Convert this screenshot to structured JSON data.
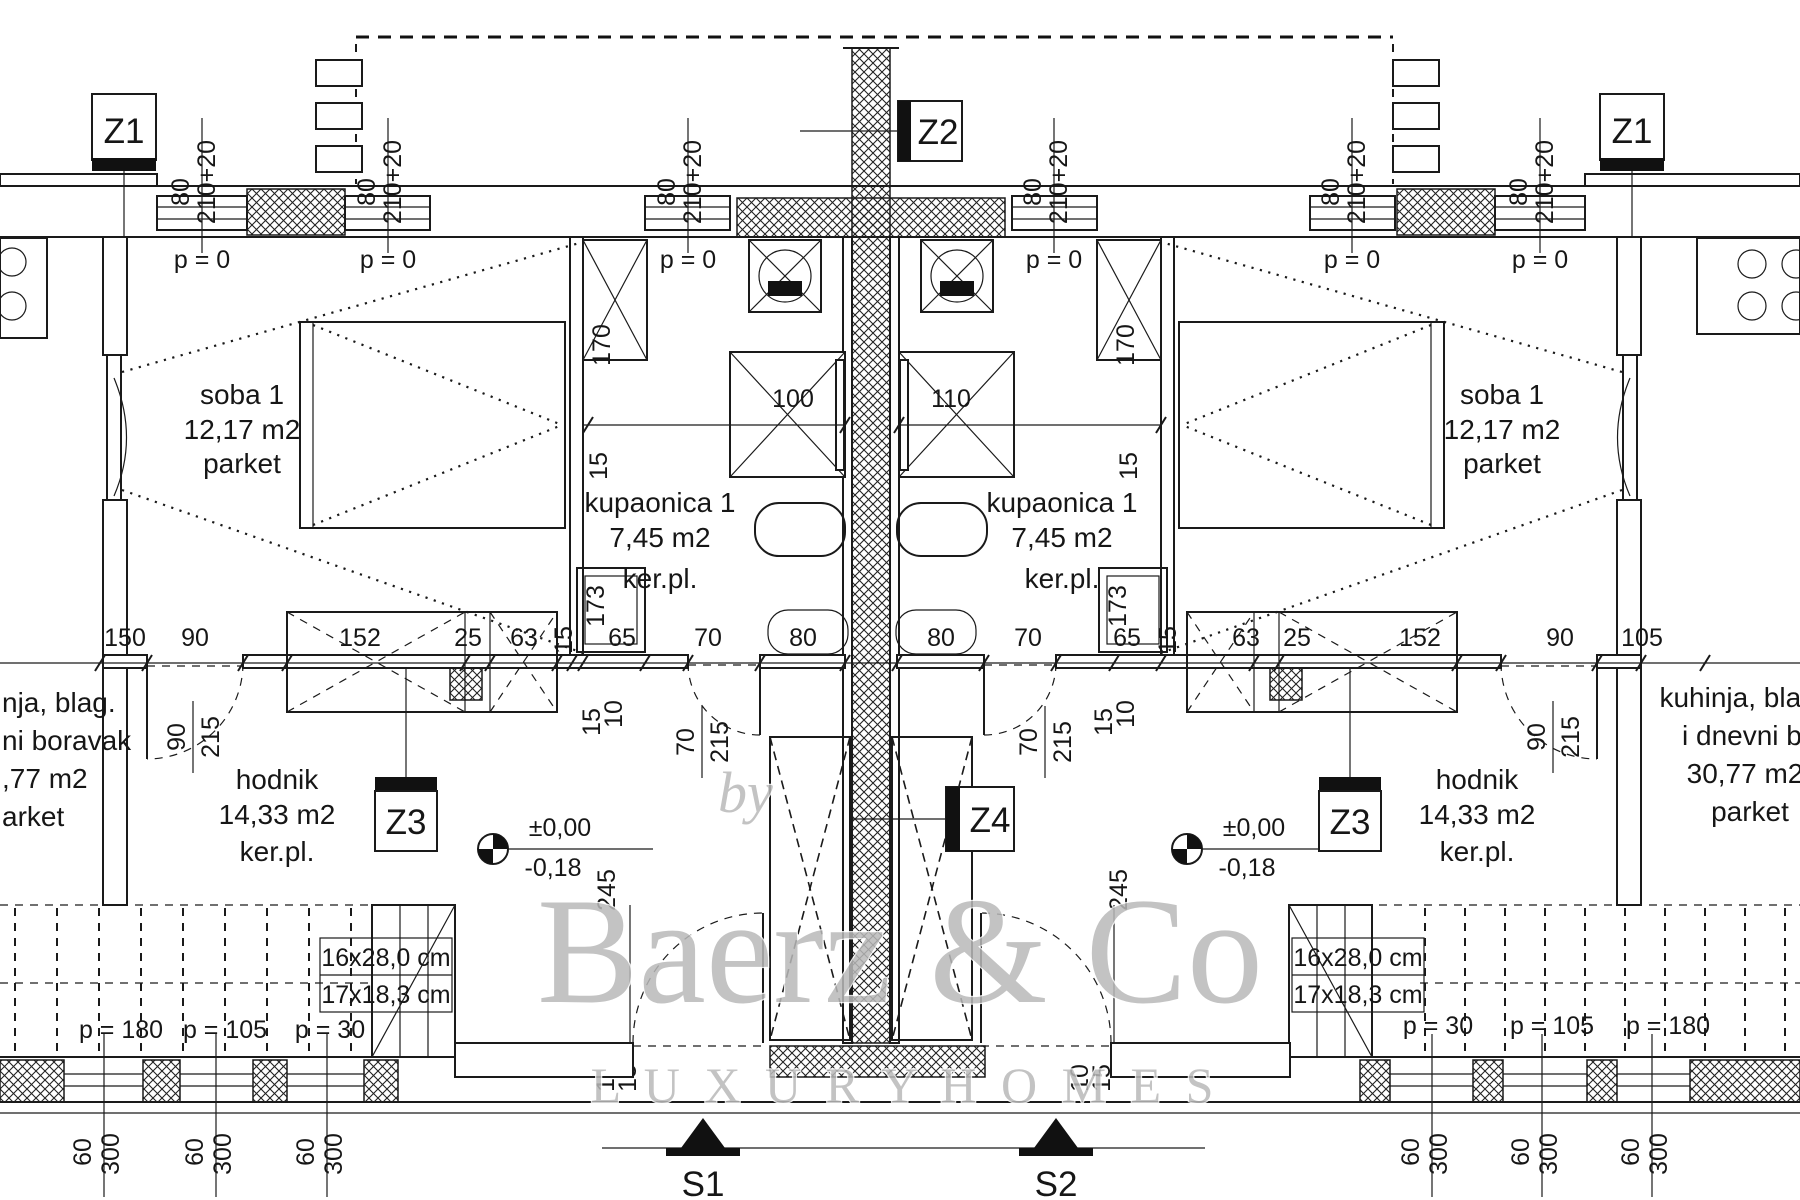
{
  "markers": {
    "z1": "Z1",
    "z2": "Z2",
    "z3": "Z3",
    "z4": "Z4",
    "s1": "S1",
    "s2": "S2"
  },
  "rooms": {
    "soba": {
      "title": "soba 1",
      "area": "12,17 m2",
      "floor": "parket"
    },
    "kupaonica": {
      "title": "kupaonica 1",
      "area": "7,45 m2",
      "floor": "ker.pl."
    },
    "hodnik": {
      "title": "hodnik",
      "area": "14,33 m2",
      "floor": "ker.pl."
    },
    "kuhinja_left": {
      "l1": "nja, blag.",
      "l2": "ni boravak",
      "l3": ",77 m2",
      "l4": "arket"
    },
    "kuhinja_right": {
      "l1": "kuhinja, blag.",
      "l2": "i dnevni boravak",
      "l3": "30,77 m2",
      "l4": "parket"
    }
  },
  "levels": {
    "upper": "±0,00",
    "lower": "-0,18"
  },
  "stairs": {
    "riser1": "16x28,0 cm",
    "riser2": "17x18,3 cm",
    "p180": "p = 180",
    "p105": "p = 105",
    "p30": "p = 30"
  },
  "dims": {
    "d80": "80",
    "d210": "210+20",
    "p0": "p = 0",
    "d150": "150",
    "d90": "90",
    "d152": "152",
    "d25": "25",
    "d63": "63",
    "d65": "65",
    "d70": "70",
    "d100": "100",
    "d110": "110",
    "d105": "105",
    "d15": "15",
    "d10": "10",
    "d170": "170",
    "d173": "173",
    "d215": "215",
    "d245": "245",
    "d60": "60",
    "d300": "300"
  },
  "watermark": {
    "by": "by",
    "brand": "Baerz & Co",
    "tagline": "L U X U R Y   H O M E S"
  }
}
